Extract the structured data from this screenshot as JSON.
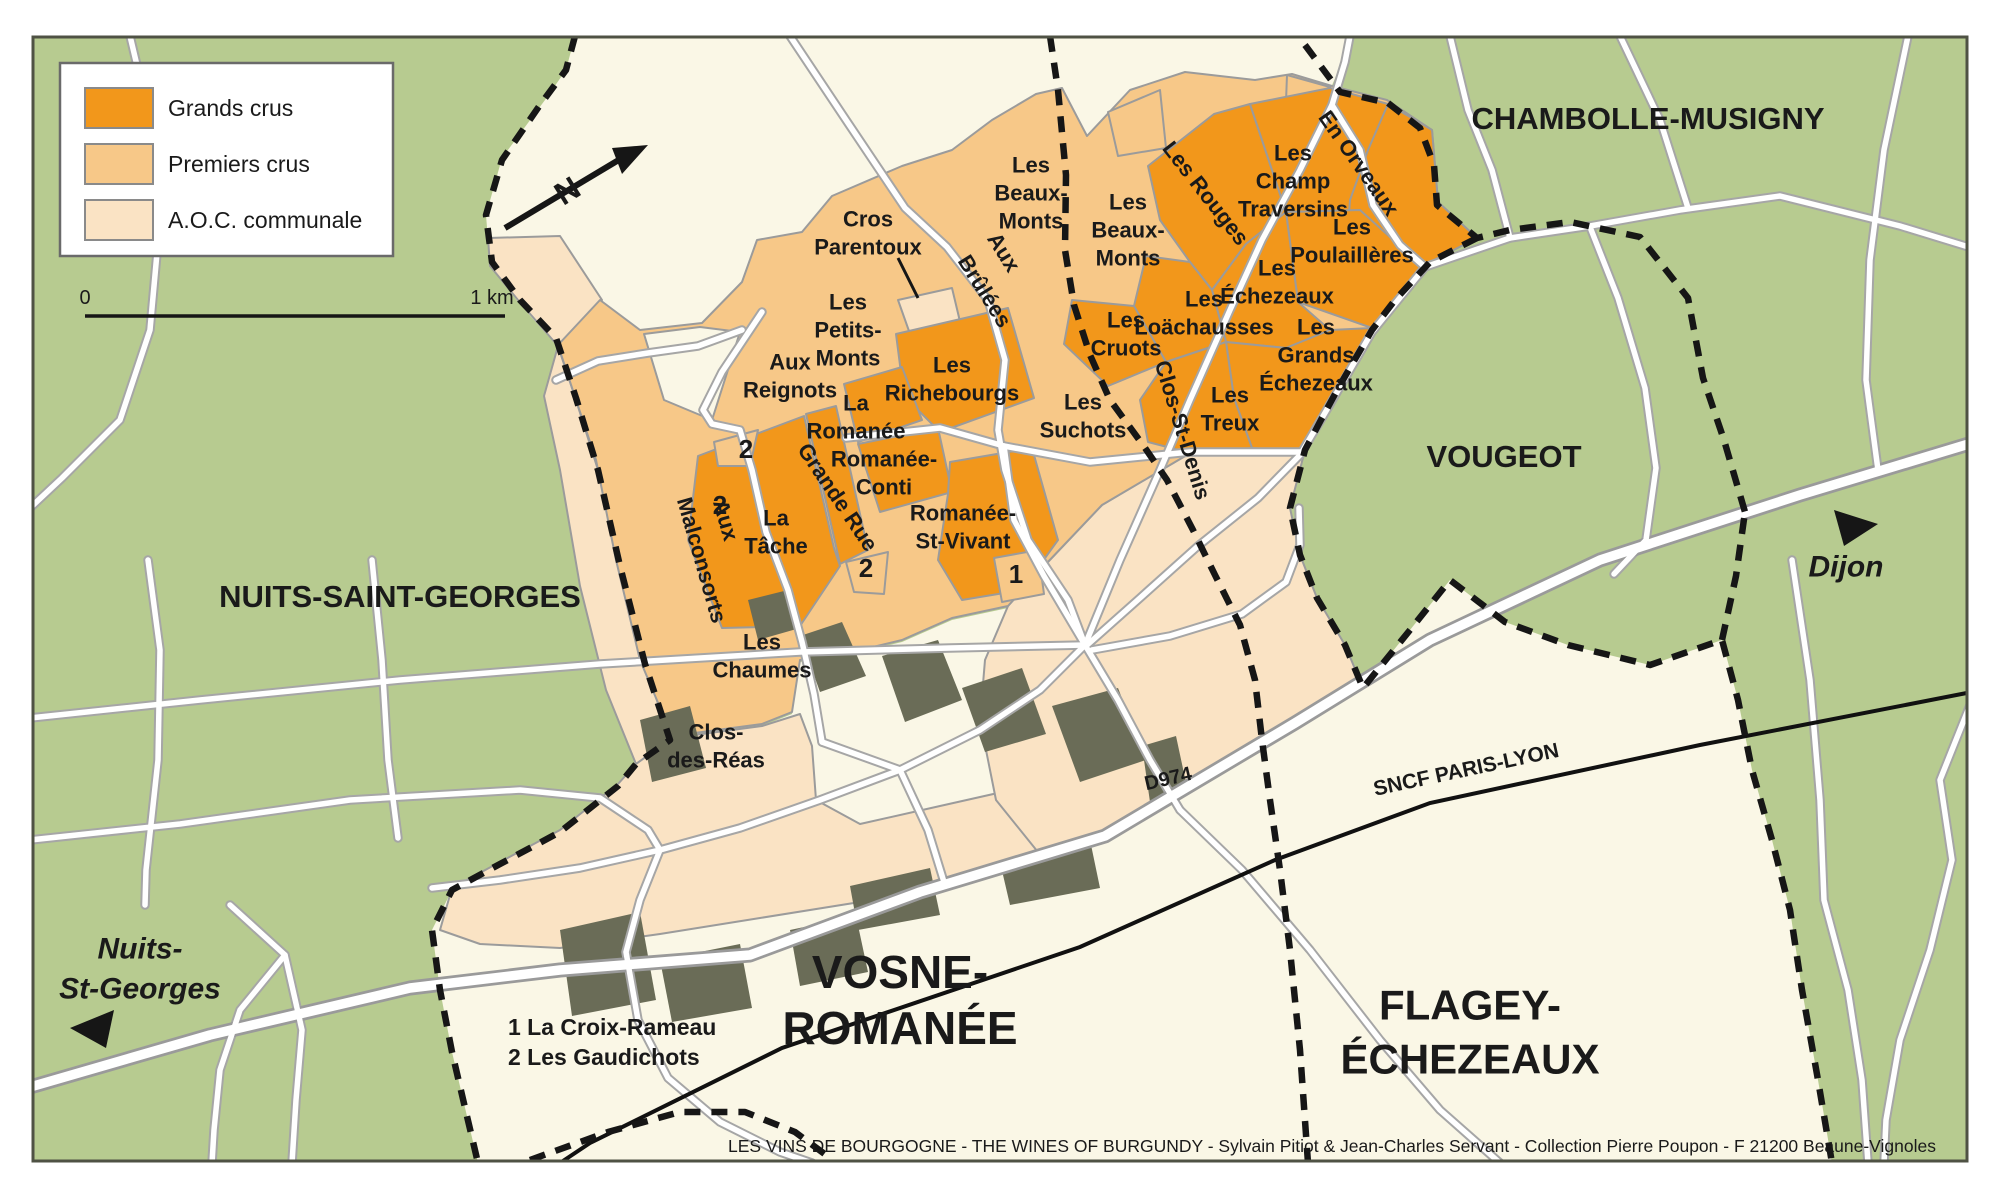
{
  "colors": {
    "grand_cru": "#F2971B",
    "premier_cru": "#F7C888",
    "aoc_communale": "#FAE3C4",
    "woodland_green": "#B7CB90",
    "commune_cream": "#FAF7E6",
    "village_dark": "#6A6C57",
    "road_casing": "#A6A6A6",
    "boundary_black": "#161616",
    "label_black": "#1A1A1A",
    "region_label_green": "#70745F"
  },
  "legend": {
    "items": [
      {
        "label": "Grands crus",
        "color_key": "grand_cru"
      },
      {
        "label": "Premiers crus",
        "color_key": "premier_cru"
      },
      {
        "label": "A.O.C. communale",
        "color_key": "aoc_communale"
      }
    ]
  },
  "scale": {
    "start": "0",
    "end": "1 km"
  },
  "north_label": "N",
  "footnotes": [
    "1  La Croix-Rameau",
    "2  Les Gaudichots"
  ],
  "caption": "LES VINS DE BOURGOGNE - THE WINES OF BURGUNDY - Sylvain Pitiot & Jean-Charles Servant - Collection Pierre Poupon - F 21200 Beaune-Vignoles",
  "map_labels": [
    {
      "id": "label-cros-parentoux",
      "t": [
        "Cros",
        "Parentoux"
      ],
      "x": 868,
      "y": 233
    },
    {
      "id": "label-les-beaux-monts-west",
      "t": [
        "Les",
        "Beaux-",
        "Monts"
      ],
      "x": 1031,
      "y": 193
    },
    {
      "id": "label-les-beaux-monts-east",
      "t": [
        "Les",
        "Beaux-",
        "Monts"
      ],
      "x": 1128,
      "y": 230
    },
    {
      "id": "label-aux-brulees-line1",
      "t": [
        "Aux"
      ],
      "x": 1004,
      "y": 252,
      "r": 58
    },
    {
      "id": "label-aux-brulees-line2",
      "t": [
        "Brûlées"
      ],
      "x": 985,
      "y": 291,
      "r": 58
    },
    {
      "id": "label-les-petits-monts",
      "t": [
        "Les",
        "Petits-",
        "Monts"
      ],
      "x": 848,
      "y": 330
    },
    {
      "id": "label-aux-reignots",
      "t": [
        "Aux",
        "Reignots"
      ],
      "x": 790,
      "y": 376
    },
    {
      "id": "label-la-romanee",
      "t": [
        "La",
        "Romanée"
      ],
      "x": 856,
      "y": 417
    },
    {
      "id": "label-les-richebourgs",
      "t": [
        "Les",
        "Richebourgs"
      ],
      "x": 952,
      "y": 379
    },
    {
      "id": "label-romanee-conti",
      "t": [
        "Romanée-",
        "Conti"
      ],
      "x": 884,
      "y": 473
    },
    {
      "id": "label-romanee-st-vivant",
      "t": [
        "Romanée-",
        "St-Vivant"
      ],
      "x": 963,
      "y": 527
    },
    {
      "id": "label-les-suchots",
      "t": [
        "Les",
        "Suchots"
      ],
      "x": 1083,
      "y": 416
    },
    {
      "id": "label-grande-rue",
      "t": [
        "Grande Rue"
      ],
      "x": 838,
      "y": 497,
      "r": 56
    },
    {
      "id": "label-la-tache",
      "t": [
        "La",
        "Tâche"
      ],
      "x": 776,
      "y": 532
    },
    {
      "id": "label-aux-malconsorts-line1",
      "t": [
        "Aux"
      ],
      "x": 726,
      "y": 520,
      "r": 74
    },
    {
      "id": "label-aux-malconsorts-line2",
      "t": [
        "Malconsorts"
      ],
      "x": 702,
      "y": 560,
      "r": 74
    },
    {
      "id": "label-les-chaumes",
      "t": [
        "Les",
        "Chaumes"
      ],
      "x": 762,
      "y": 656
    },
    {
      "id": "label-clos-des-reas",
      "t": [
        "Clos-",
        "des-Réas"
      ],
      "x": 716,
      "y": 746
    },
    {
      "id": "label-les-rouges",
      "t": [
        "Les Rouges"
      ],
      "x": 1206,
      "y": 193,
      "r": 52
    },
    {
      "id": "label-les-champ-traversins",
      "t": [
        "Les",
        "Champ",
        "Traversins"
      ],
      "x": 1293,
      "y": 181
    },
    {
      "id": "label-en-orveaux",
      "t": [
        "En Orveaux"
      ],
      "x": 1359,
      "y": 163,
      "r": 55
    },
    {
      "id": "label-les-poulailleres",
      "t": [
        "Les",
        "Poulaillères"
      ],
      "x": 1352,
      "y": 241
    },
    {
      "id": "label-les-echezeaux",
      "t": [
        "Les",
        "Échezeaux"
      ],
      "x": 1277,
      "y": 282
    },
    {
      "id": "label-les-loachausses",
      "t": [
        "Les",
        "Loächausses"
      ],
      "x": 1204,
      "y": 313
    },
    {
      "id": "label-les-cruots",
      "t": [
        "Les",
        "Cruots"
      ],
      "x": 1126,
      "y": 334
    },
    {
      "id": "label-les-grands-echezeaux",
      "t": [
        "Les",
        "Grands",
        "Échezeaux"
      ],
      "x": 1316,
      "y": 355
    },
    {
      "id": "label-les-treux",
      "t": [
        "Les",
        "Treux"
      ],
      "x": 1230,
      "y": 409
    },
    {
      "id": "label-clos-st-denis",
      "t": [
        "Clos-St-Denis"
      ],
      "x": 1183,
      "y": 430,
      "r": 73
    },
    {
      "id": "marker-2-les-gaudichots-north",
      "t": [
        "2"
      ],
      "x": 746,
      "y": 449,
      "s": 26
    },
    {
      "id": "marker-2-les-gaudichots-west",
      "t": [
        "2"
      ],
      "x": 720,
      "y": 505,
      "s": 26
    },
    {
      "id": "marker-2-les-gaudichots-south",
      "t": [
        "2"
      ],
      "x": 866,
      "y": 568,
      "s": 26
    },
    {
      "id": "marker-1-la-croix-rameau",
      "t": [
        "1"
      ],
      "x": 1016,
      "y": 574,
      "s": 26
    },
    {
      "id": "label-region-chambolle-musigny",
      "t": [
        "CHAMBOLLE-MUSIGNY"
      ],
      "x": 1648,
      "y": 118,
      "s": 31
    },
    {
      "id": "label-region-vougeot",
      "t": [
        "VOUGEOT"
      ],
      "x": 1504,
      "y": 456,
      "s": 31
    },
    {
      "id": "label-region-nuits-saint-georges",
      "t": [
        "NUITS-SAINT-GEORGES"
      ],
      "x": 400,
      "y": 596,
      "s": 31
    },
    {
      "id": "label-region-vosne-romanee",
      "t": [
        "VOSNE-",
        "ROMANÉE"
      ],
      "x": 900,
      "y": 1000,
      "s": 46,
      "lh": 56,
      "f": "#70745F"
    },
    {
      "id": "label-region-flagey-echezeaux",
      "t": [
        "FLAGEY-",
        "ÉCHEZEAUX"
      ],
      "x": 1470,
      "y": 1032,
      "s": 42,
      "lh": 54,
      "f": "#70745F"
    },
    {
      "id": "label-dest-nuits-st-georges",
      "t": [
        "Nuits-",
        "St-Georges"
      ],
      "x": 140,
      "y": 968,
      "s": 30,
      "it": true,
      "lh": 40
    },
    {
      "id": "label-dest-dijon",
      "t": [
        "Dijon"
      ],
      "x": 1846,
      "y": 566,
      "s": 30,
      "it": true
    },
    {
      "id": "label-road-d974",
      "t": [
        "D974"
      ],
      "x": 1168,
      "y": 778,
      "s": 20,
      "r": -13
    },
    {
      "id": "label-railway-sncf-paris-lyon",
      "t": [
        "SNCF PARIS-LYON"
      ],
      "x": 1466,
      "y": 769,
      "s": 21,
      "r": -12
    }
  ]
}
